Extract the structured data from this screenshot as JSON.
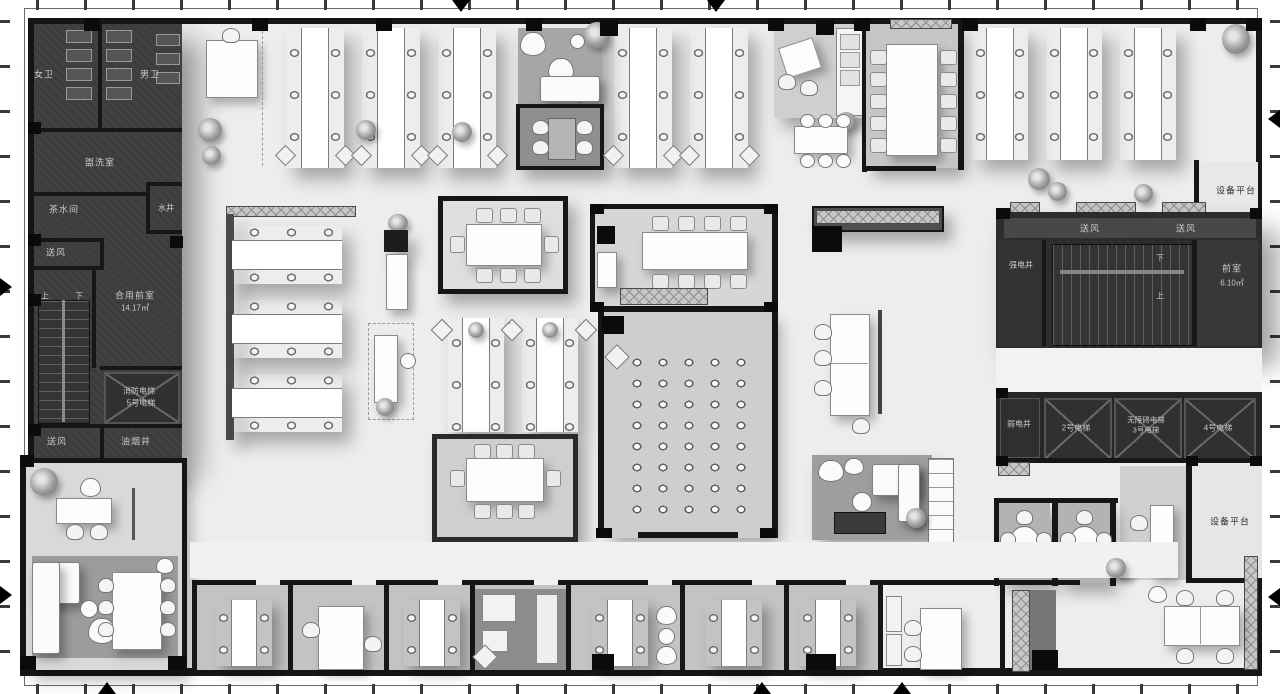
{
  "colors": {
    "wall": "#161616",
    "core_fill": "#3d3d3d",
    "floor": "#ededed"
  },
  "labels": {
    "women_wc": "女卫",
    "men_wc": "男卫",
    "washroom": "盥洗室",
    "tea_room": "茶水间",
    "water_shaft": "水井",
    "air_supply": "送风",
    "shared_front_room": "合用前室",
    "shared_front_room_area": "14.17㎡",
    "up": "上",
    "down": "下",
    "fire_elevator": "消防电梯",
    "elevator_5": "5号电梯",
    "oil_smoke_shaft": "油烟井",
    "equipment_platform": "设备平台",
    "strong_electric_shaft": "强电井",
    "front_room": "前室",
    "front_room_area": "6.10㎡",
    "weak_electric_shaft": "弱电井",
    "elevator_2": "2号电梯",
    "accessible_elevator": "无障碍电梯",
    "elevator_3": "3号电梯",
    "elevator_4": "4号电梯"
  }
}
